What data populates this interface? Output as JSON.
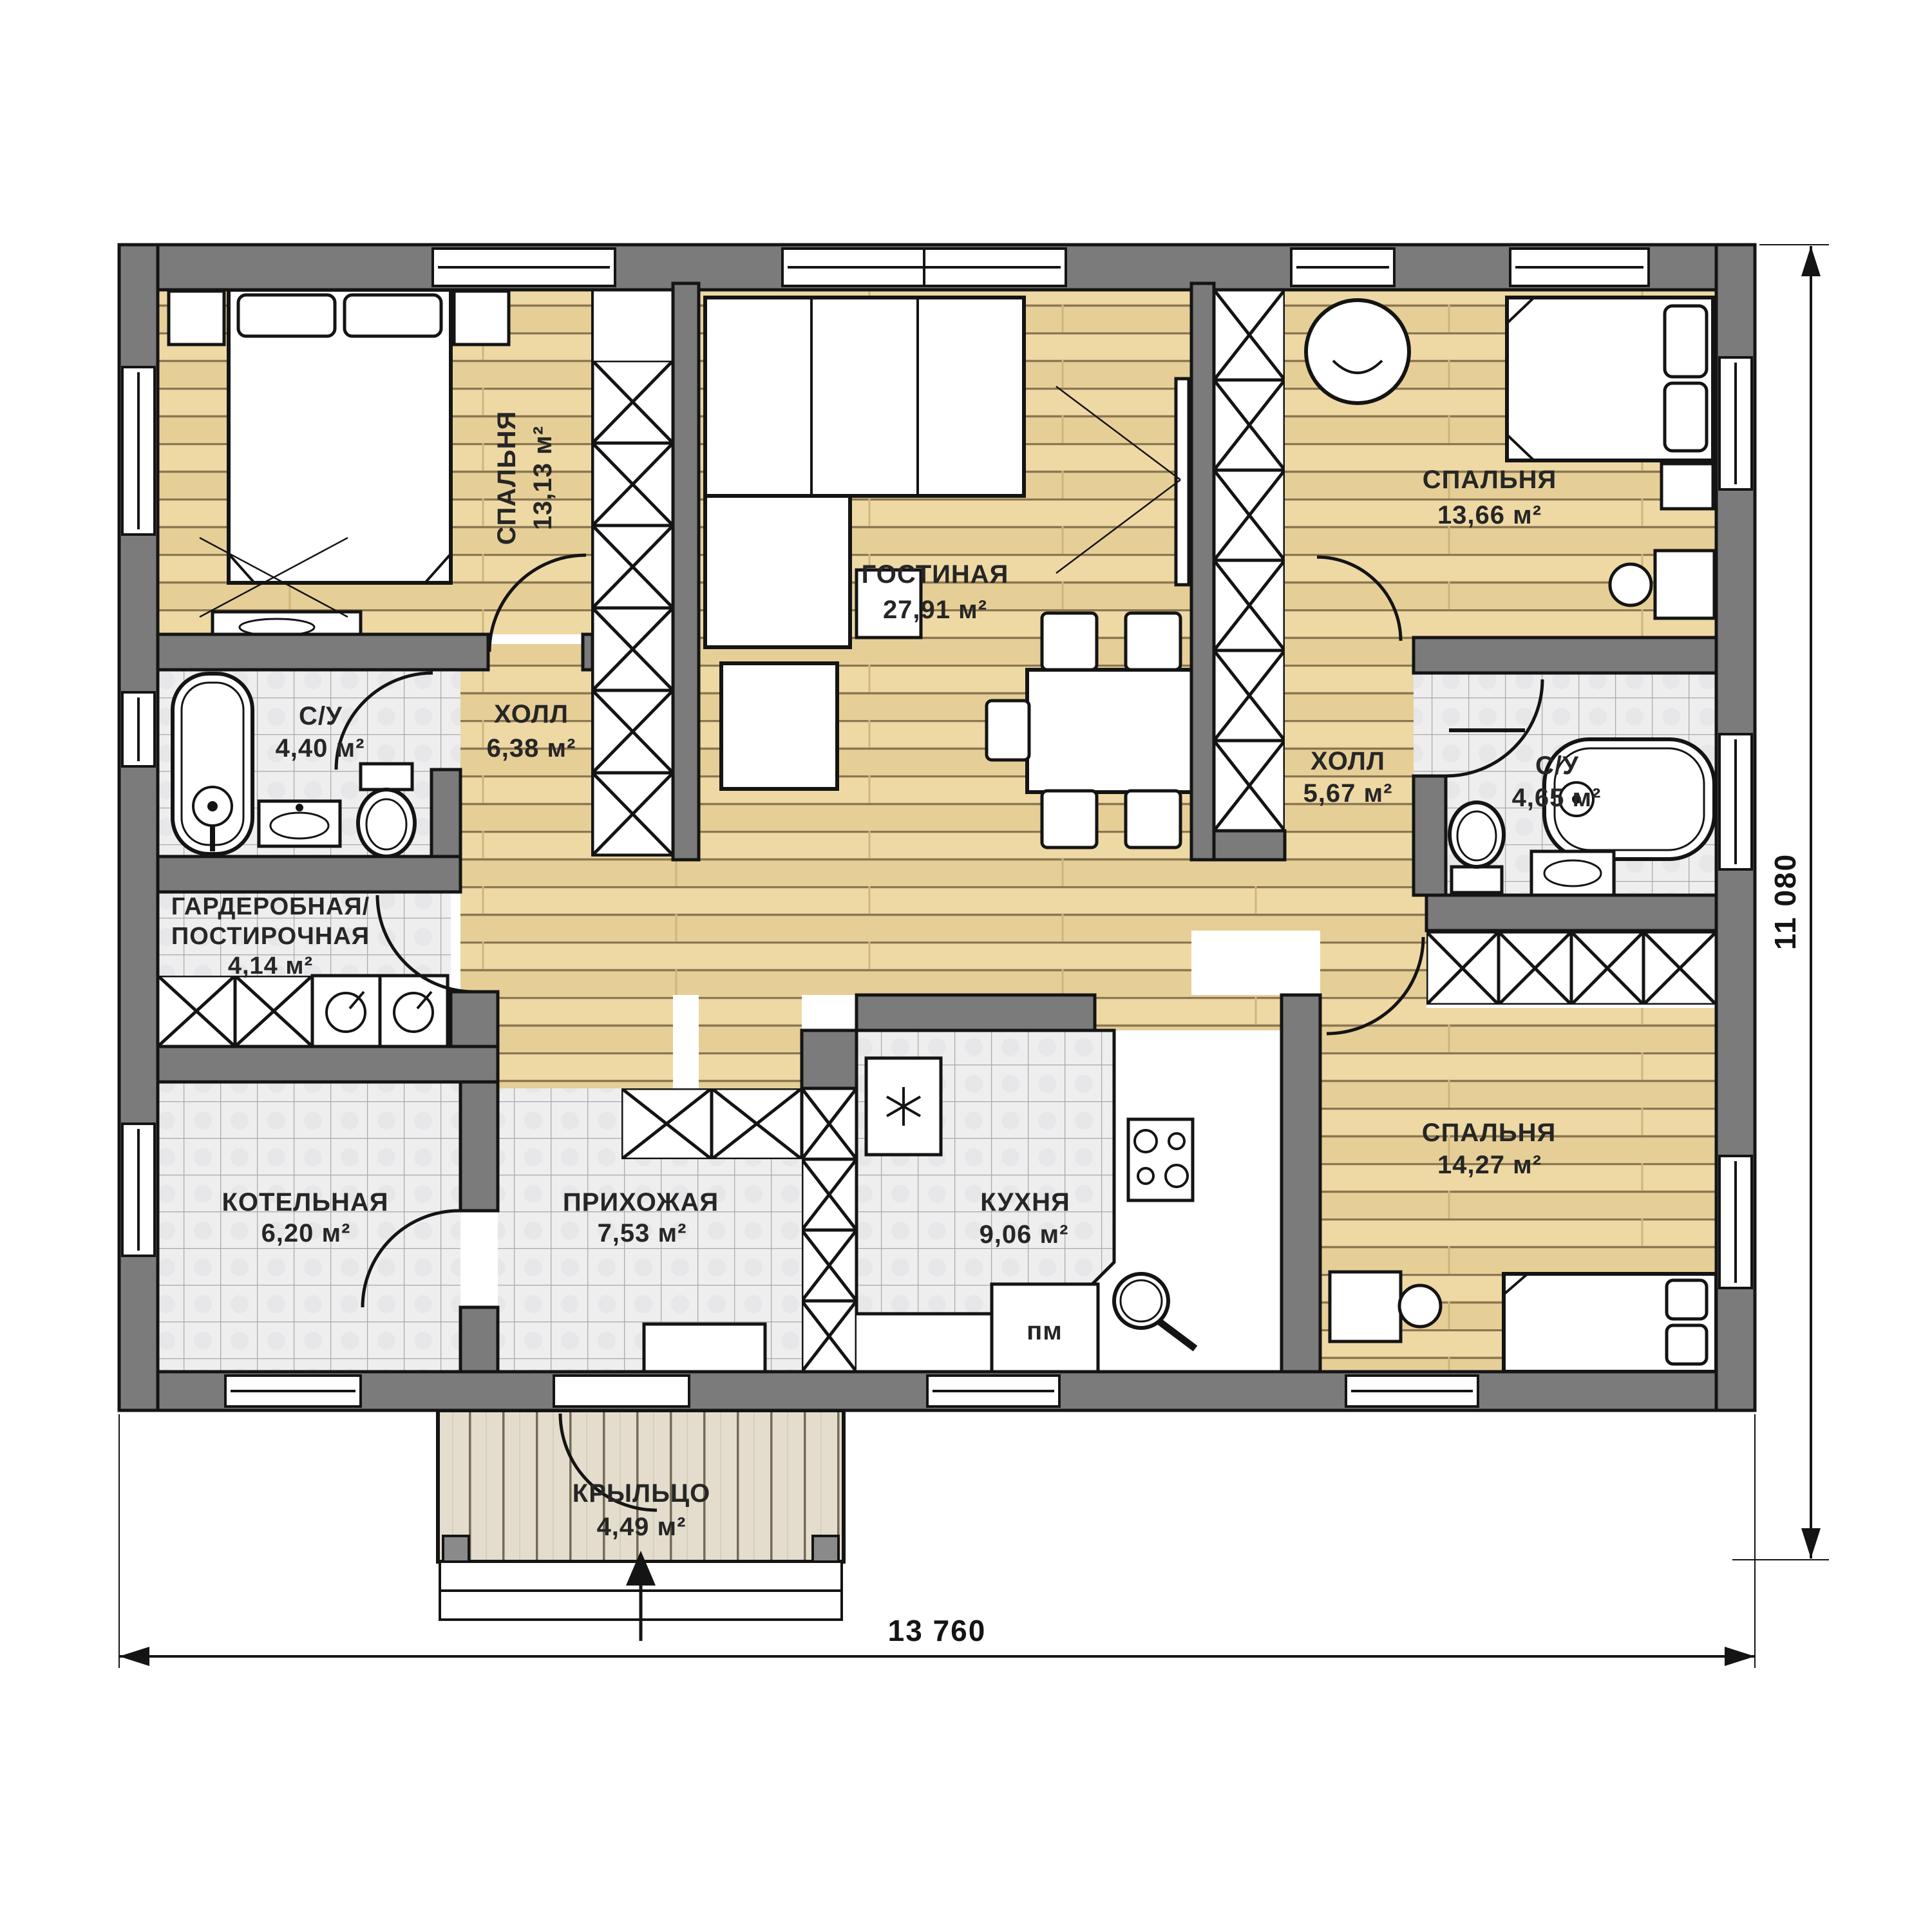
{
  "rooms": {
    "bedroom1": {
      "name": "СПАЛЬНЯ",
      "area": "13,13 м²"
    },
    "living": {
      "name": "ГОСТИНАЯ",
      "area": "27,91 м²"
    },
    "bedroom2": {
      "name": "СПАЛЬНЯ",
      "area": "13,66 м²"
    },
    "bath1": {
      "name": "С/У",
      "area": "4,40 м²"
    },
    "hall1": {
      "name": "ХОЛЛ",
      "area": "6,38 м²"
    },
    "hall2": {
      "name": "ХОЛЛ",
      "area": "5,67 м²"
    },
    "bath2": {
      "name": "С/У",
      "area": "4,65 м²"
    },
    "wardrobe": {
      "name_line1": "ГАРДЕРОБНАЯ/",
      "name_line2": "ПОСТИРОЧНАЯ",
      "area": "4,14 м²"
    },
    "boiler": {
      "name": "КОТЕЛЬНАЯ",
      "area": "6,20 м²"
    },
    "entry": {
      "name": "ПРИХОЖАЯ",
      "area": "7,53 м²"
    },
    "kitchen": {
      "name": "КУХНЯ",
      "area": "9,06 м²"
    },
    "bedroom3": {
      "name": "СПАЛЬНЯ",
      "area": "14,27 м²"
    },
    "porch": {
      "name": "КРЫЛЬЦО",
      "area": "4,49 м²"
    }
  },
  "appliances": {
    "dishwasher": "пм"
  },
  "dimensions": {
    "width": "13 760",
    "height": "11 080"
  },
  "colors": {
    "wall": "#7b7b7b",
    "line": "#141414",
    "wood": "#ead7a4",
    "tile": "#eeeeef",
    "deck": "#e4ddcd",
    "text": "#262626"
  }
}
